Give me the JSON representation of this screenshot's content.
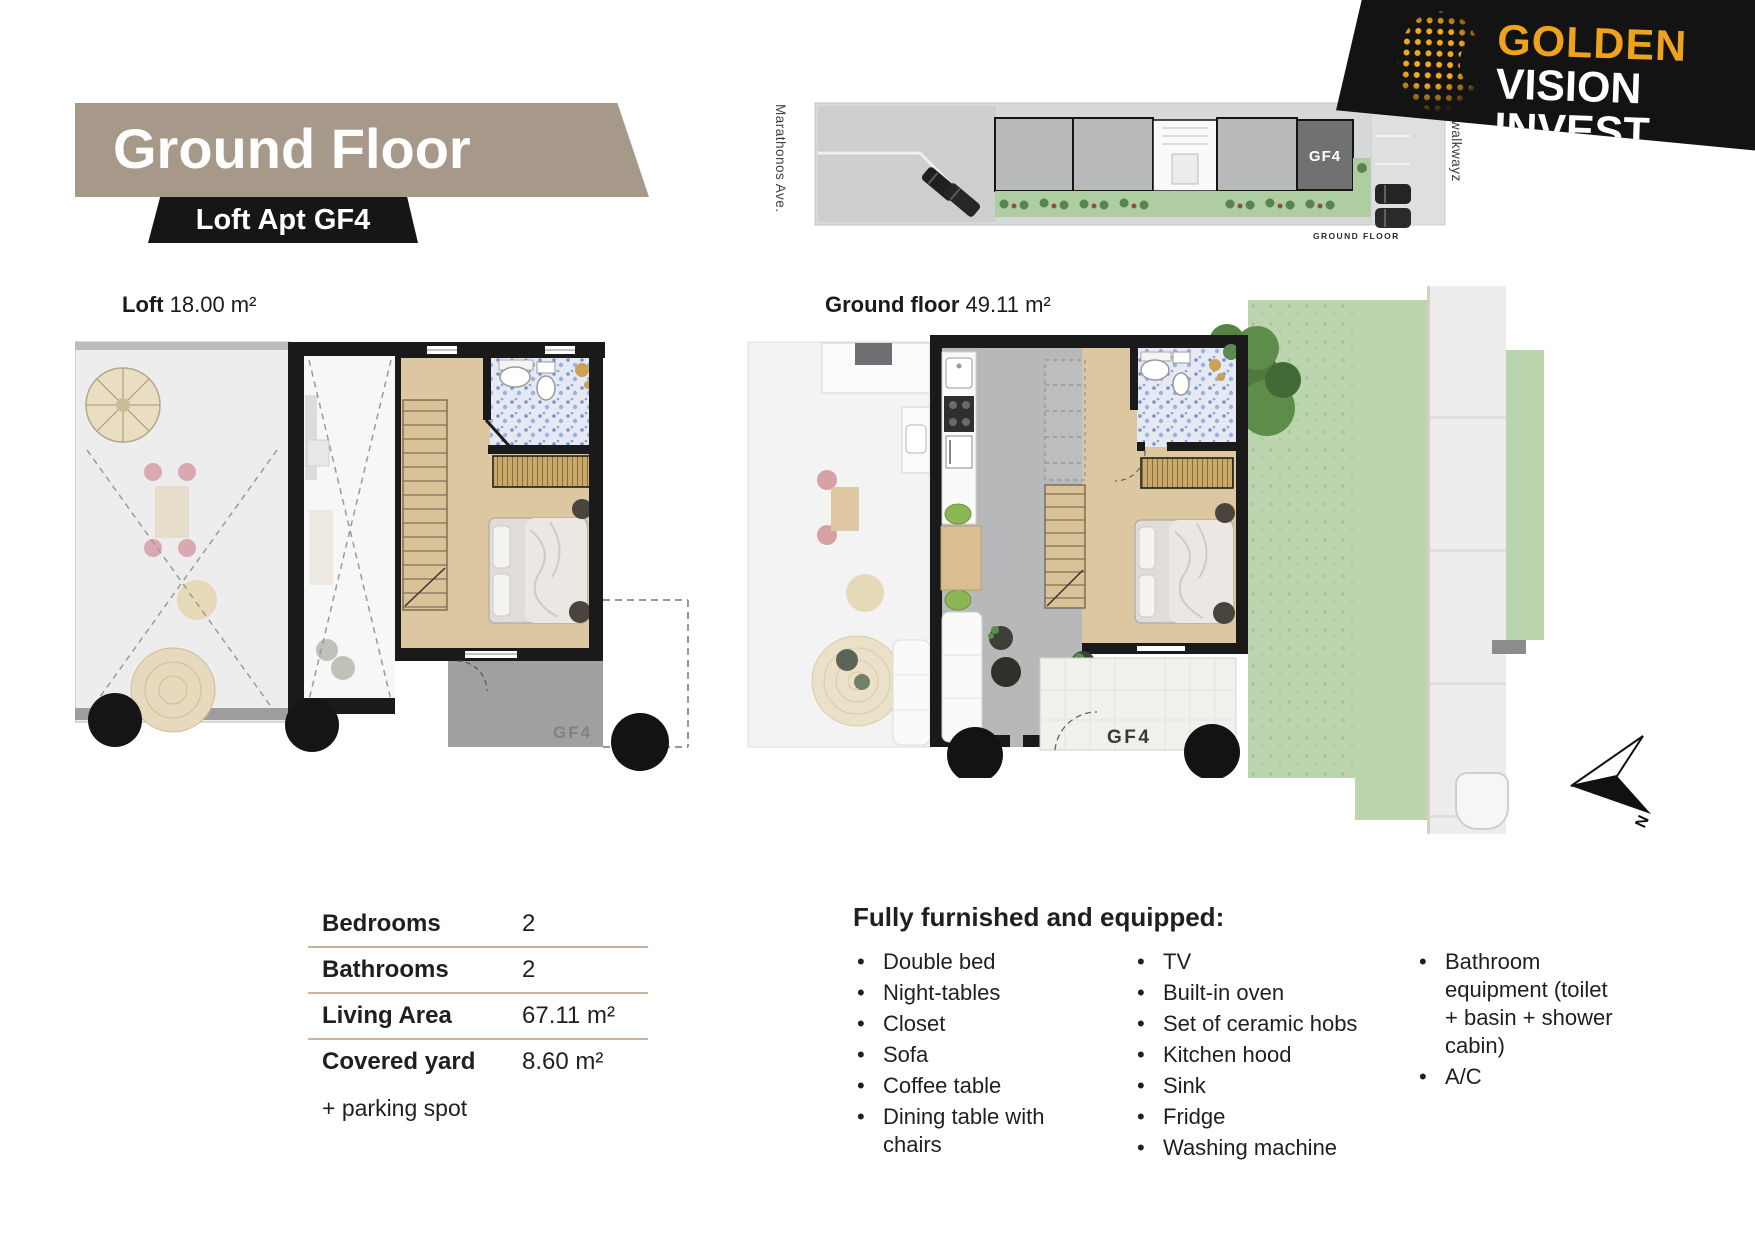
{
  "logo": {
    "brand_line1": "GOLDEN",
    "brand_line2": "VISION INVEST"
  },
  "title": {
    "heading": "Ground Floor",
    "subheading": "Loft Apt GF4"
  },
  "site_plan": {
    "street_label": "Marathonos Ave.",
    "walkway_label": "walkwayz",
    "unit_label": "GF4",
    "caption": "GROUND FLOOR"
  },
  "loft_plan": {
    "label_bold": "Loft",
    "label_area": " 18.00 m²",
    "unit_label": "GF4"
  },
  "ground_plan": {
    "label_bold": "Ground floor",
    "label_area": " 49.11 m²",
    "unit_label": "GF4"
  },
  "compass": {
    "label": "N"
  },
  "specs": {
    "rows": [
      {
        "label": "Bedrooms",
        "value": "2"
      },
      {
        "label": "Bathrooms",
        "value": "2"
      },
      {
        "label": "Living Area",
        "value": "67.11 m²"
      },
      {
        "label": "Covered yard",
        "value": "8.60 m²"
      }
    ],
    "note": "+ parking spot"
  },
  "furnishing": {
    "heading": "Fully furnished and equipped:",
    "columns": [
      [
        "Double bed",
        "Night-tables",
        "Closet",
        "Sofa",
        "Coffee table",
        "Dining table with chairs"
      ],
      [
        "TV",
        "Built-in oven",
        "Set of ceramic hobs",
        "Kitchen hood",
        "Sink",
        "Fridge",
        "Washing machine"
      ],
      [
        "Bathroom equipment (toilet + basin + shower cabin)",
        "A/C"
      ]
    ]
  },
  "colors": {
    "accent_gold": "#EFA31C",
    "banner_tan": "#A6998A",
    "banner_black": "#161616",
    "separator_tan": "#C8B19B",
    "wood": "#DCC7A0",
    "lawn_green": "#BBD5AF",
    "concrete_gray": "#B6B8BA"
  }
}
